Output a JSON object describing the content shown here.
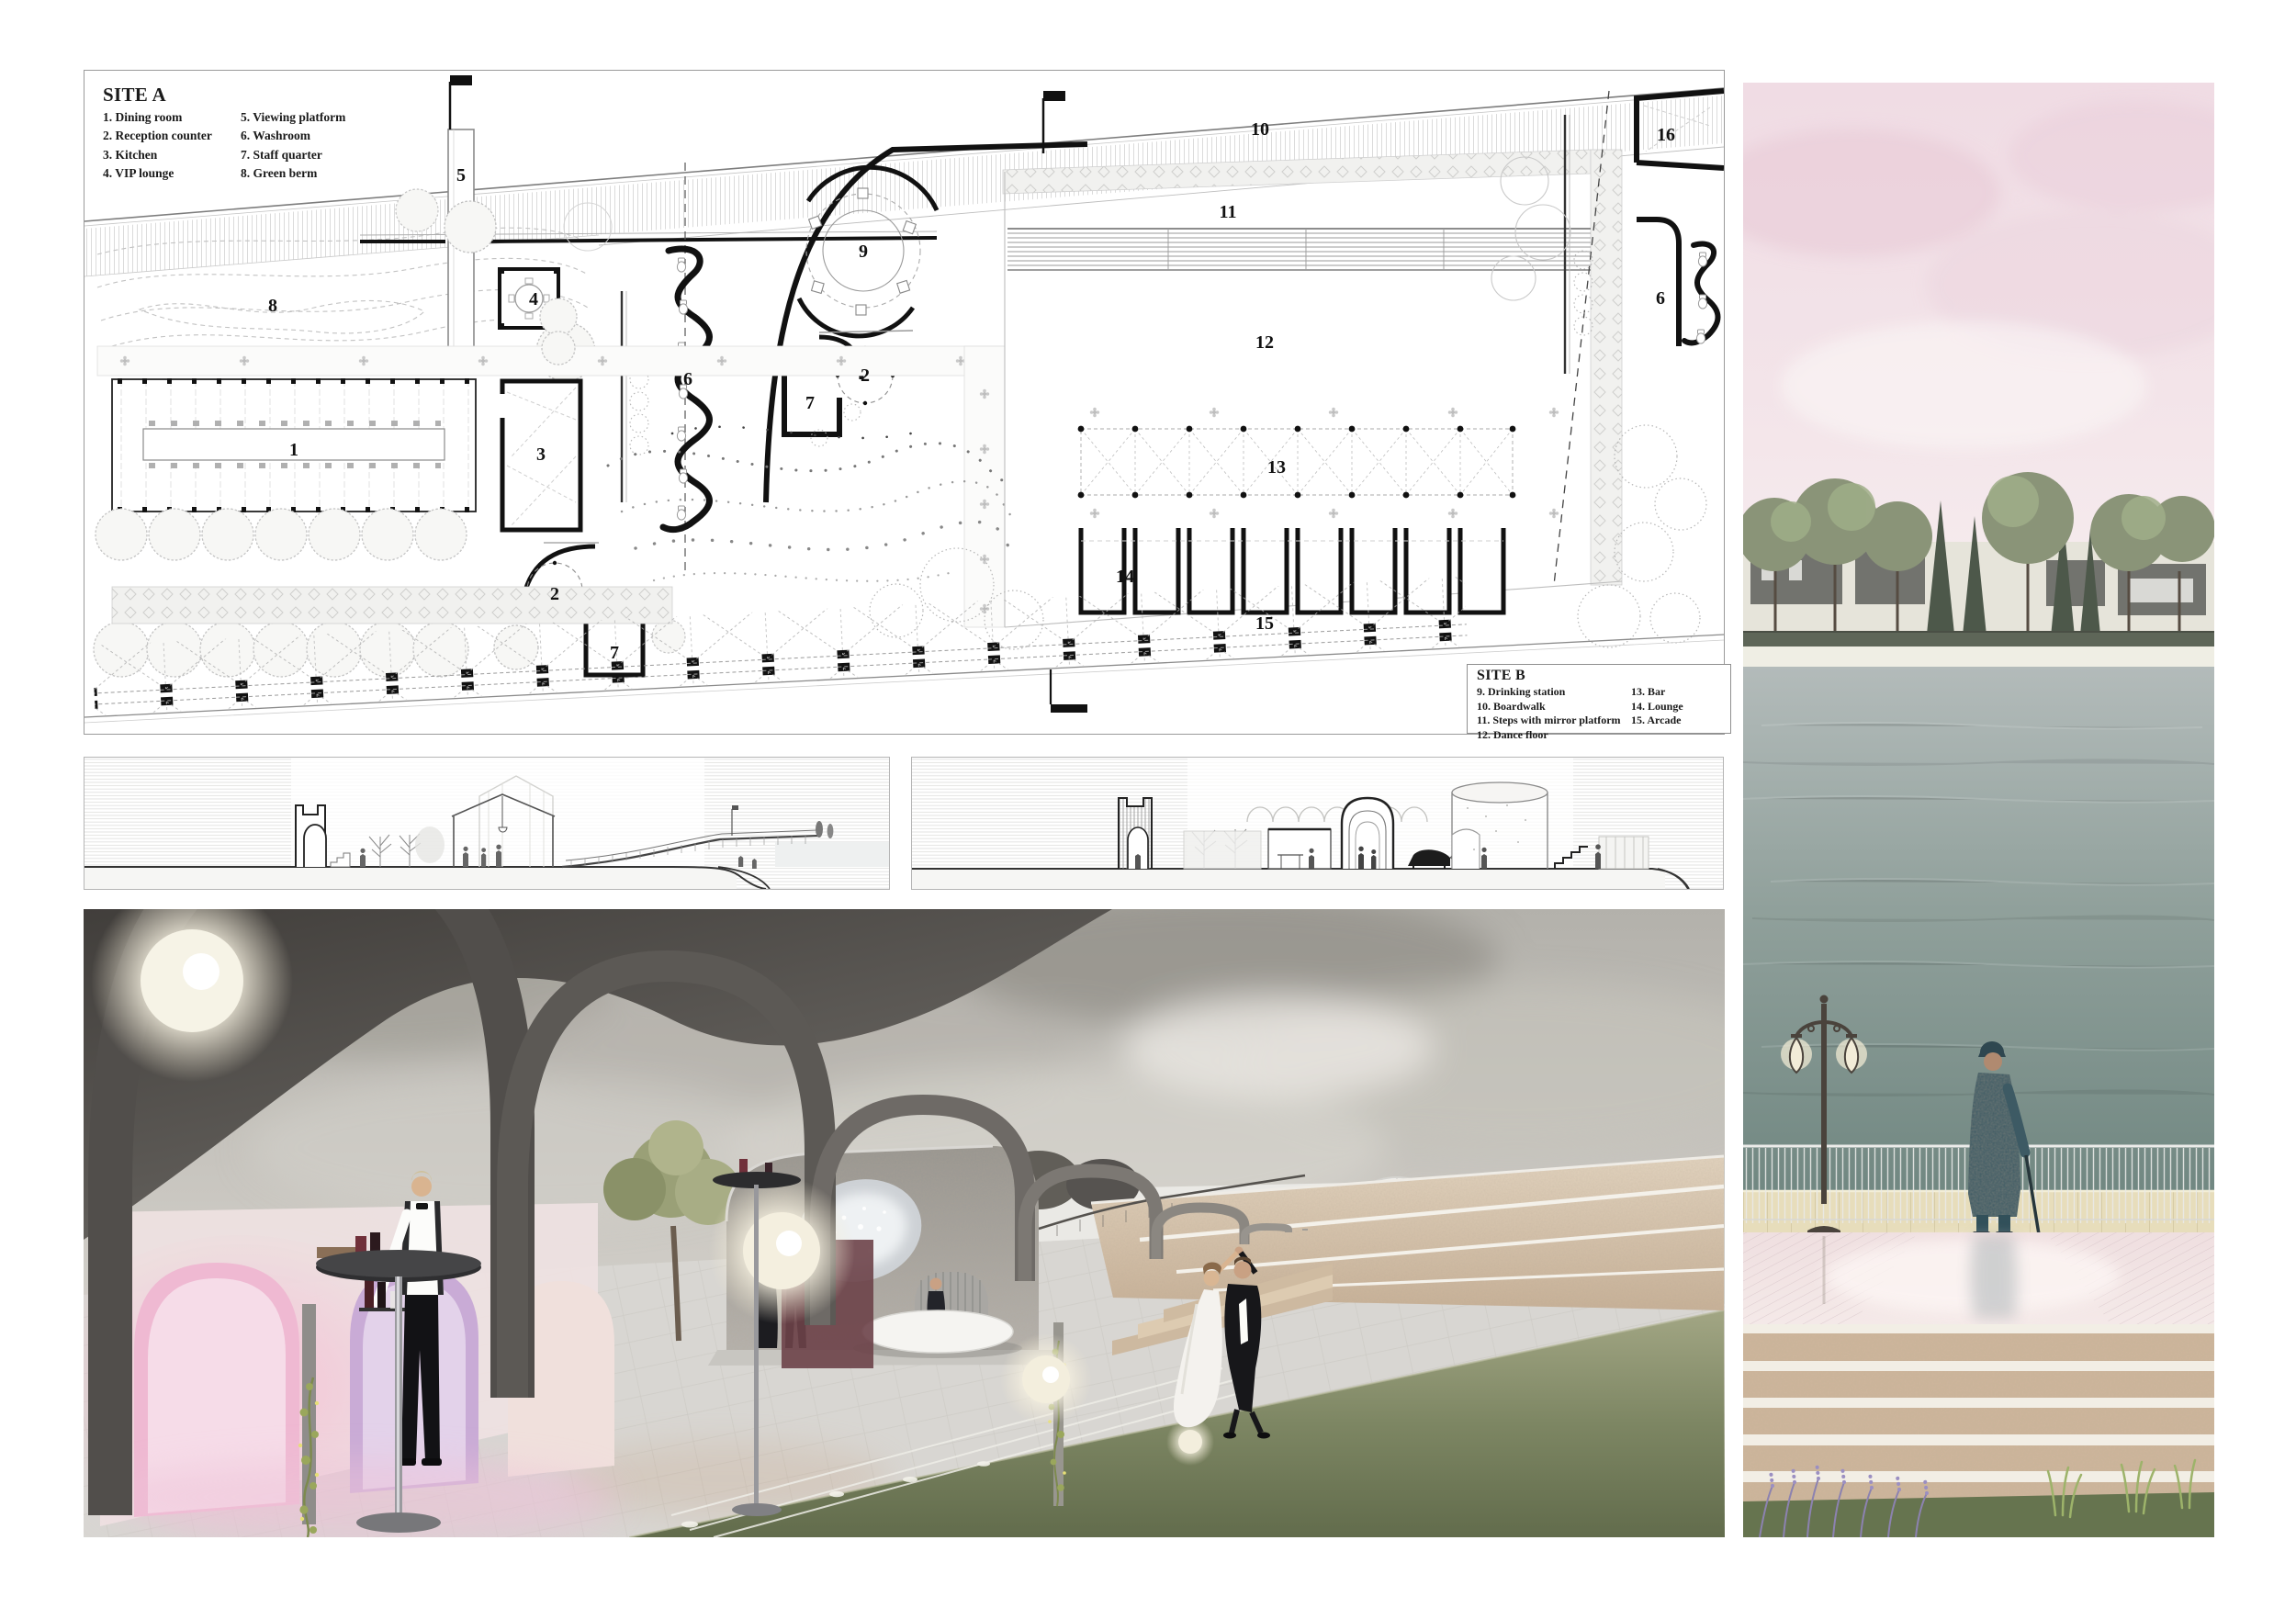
{
  "plan": {
    "legend_a": {
      "title": "SITE A",
      "col1": [
        "1. Dining room",
        "2. Reception counter",
        "3. Kitchen",
        "4. VIP lounge"
      ],
      "col2": [
        "5. Viewing platform",
        "6. Washroom",
        "7. Staff quarter",
        "8. Green berm"
      ]
    },
    "legend_b": {
      "title": "SITE B",
      "col1": [
        "9. Drinking station",
        "10. Boardwalk",
        "11. Steps with mirror platform",
        "12. Dance floor"
      ],
      "col2": [
        "13. Bar",
        "14. Lounge",
        "15. Arcade"
      ]
    },
    "labels": {
      "l1": "1",
      "l2": "2",
      "l3": "3",
      "l4": "4",
      "l5": "5",
      "l6": "6",
      "l7": "7",
      "l8": "8",
      "l9": "9",
      "l10": "10",
      "l11": "11",
      "l12": "12",
      "l13": "13",
      "l14": "14",
      "l15": "15",
      "l16": "16"
    }
  }
}
